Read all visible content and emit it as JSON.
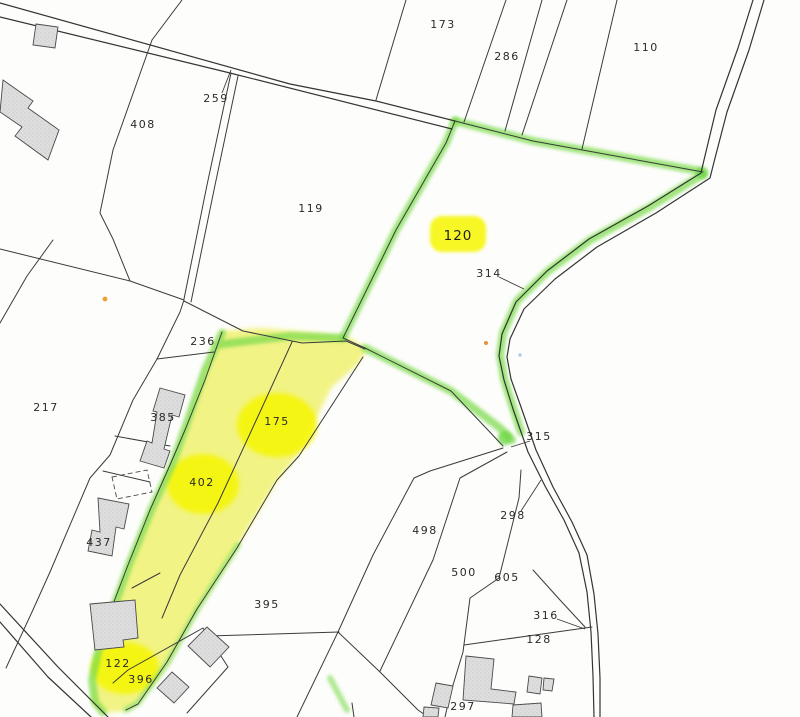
{
  "map": {
    "type": "cadastral-parcel-map",
    "colors": {
      "background": "#fdfdfb",
      "boundary_line": "#3b3b3b",
      "highlight_yellow": "#f6f600",
      "highlight_green": "#7adb4b",
      "building_fill": "#dedede",
      "label_text": "#2a2a2a"
    },
    "parcels": [
      {
        "id": "173",
        "x": 443,
        "y": 28,
        "highlighted": false
      },
      {
        "id": "286",
        "x": 507,
        "y": 60,
        "highlighted": false
      },
      {
        "id": "110",
        "x": 646,
        "y": 51,
        "highlighted": false
      },
      {
        "id": "259",
        "x": 216,
        "y": 102,
        "highlighted": false
      },
      {
        "id": "408",
        "x": 143,
        "y": 128,
        "highlighted": false
      },
      {
        "id": "119",
        "x": 311,
        "y": 212,
        "highlighted": false
      },
      {
        "id": "120",
        "x": 458,
        "y": 240,
        "highlighted": true
      },
      {
        "id": "314",
        "x": 489,
        "y": 277,
        "highlighted": false
      },
      {
        "id": "236",
        "x": 203,
        "y": 345,
        "highlighted": false
      },
      {
        "id": "217",
        "x": 46,
        "y": 411,
        "highlighted": false
      },
      {
        "id": "385",
        "x": 163,
        "y": 421,
        "highlighted": false
      },
      {
        "id": "175",
        "x": 277,
        "y": 425,
        "highlighted": false
      },
      {
        "id": "315",
        "x": 539,
        "y": 440,
        "highlighted": false
      },
      {
        "id": "402",
        "x": 202,
        "y": 486,
        "highlighted": false
      },
      {
        "id": "298",
        "x": 513,
        "y": 519,
        "highlighted": false
      },
      {
        "id": "498",
        "x": 425,
        "y": 534,
        "highlighted": false
      },
      {
        "id": "437",
        "x": 99,
        "y": 546,
        "highlighted": false
      },
      {
        "id": "500",
        "x": 464,
        "y": 576,
        "highlighted": false
      },
      {
        "id": "605",
        "x": 507,
        "y": 581,
        "highlighted": false
      },
      {
        "id": "395",
        "x": 267,
        "y": 608,
        "highlighted": false
      },
      {
        "id": "316",
        "x": 546,
        "y": 619,
        "highlighted": false
      },
      {
        "id": "128",
        "x": 539,
        "y": 643,
        "highlighted": false
      },
      {
        "id": "122",
        "x": 118,
        "y": 667,
        "highlighted": false
      },
      {
        "id": "396",
        "x": 141,
        "y": 683,
        "highlighted": false
      },
      {
        "id": "297",
        "x": 463,
        "y": 710,
        "highlighted": false
      }
    ]
  }
}
